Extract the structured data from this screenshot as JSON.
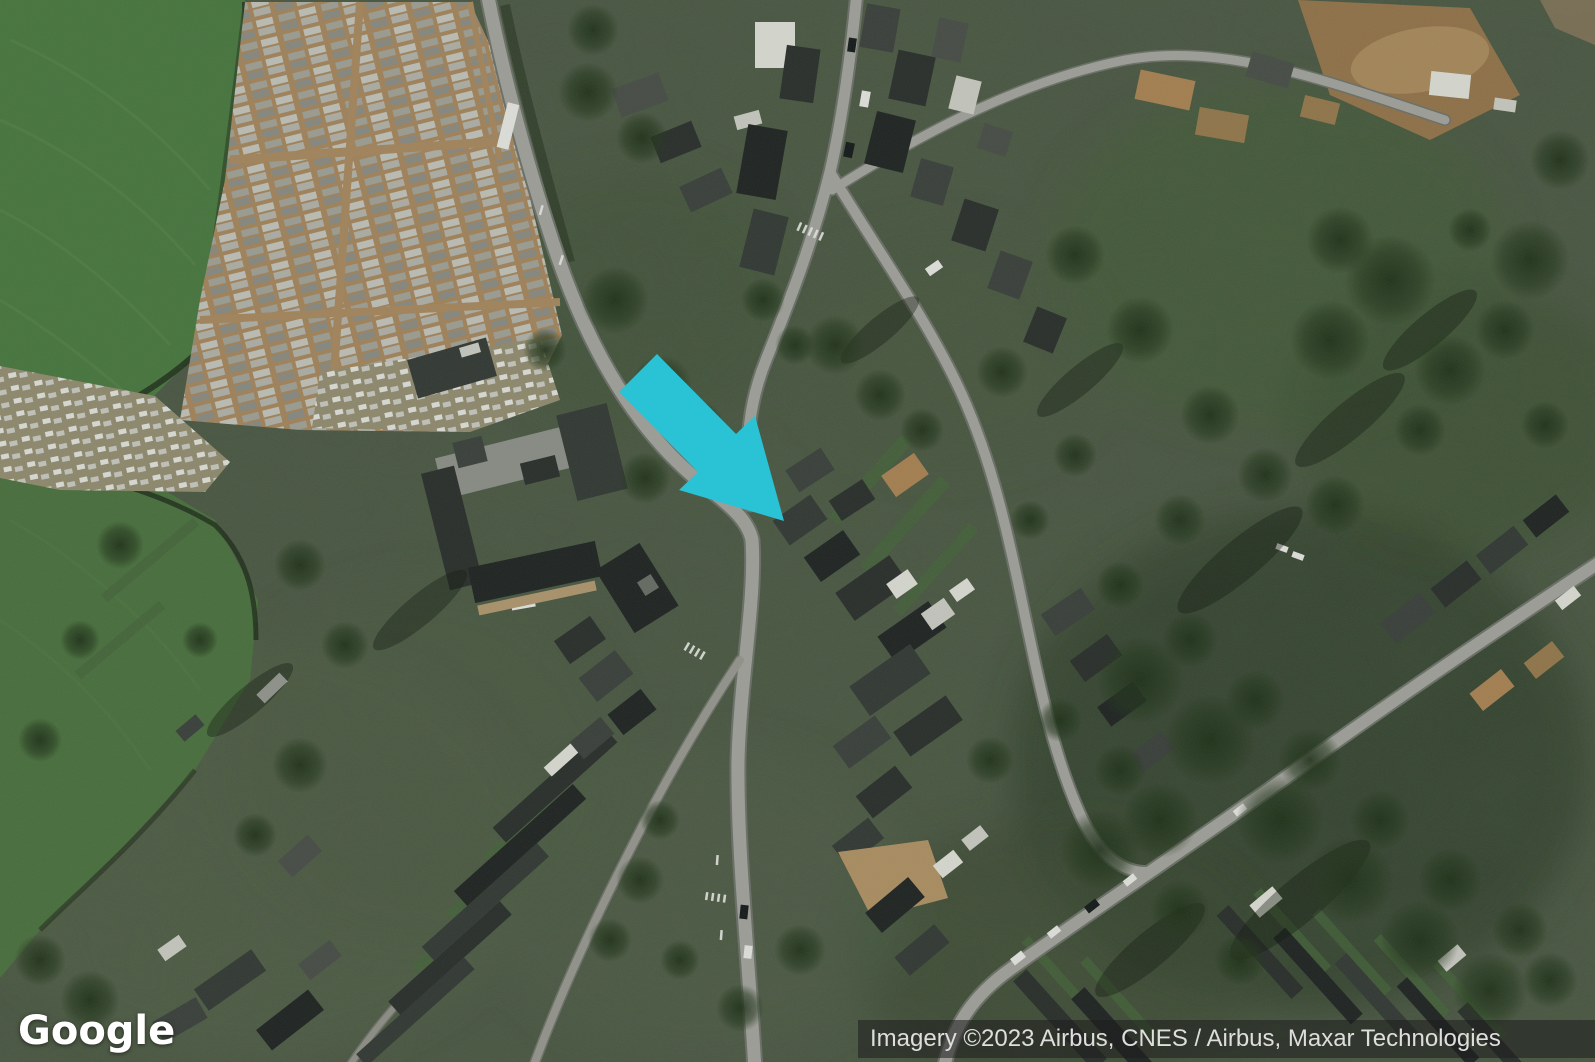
{
  "branding": {
    "logo_text": "Google"
  },
  "attribution": {
    "text": "Imagery ©2023 Airbus, CNES / Airbus, Maxar Technologies"
  },
  "marker": {
    "name": "location-arrow",
    "color": "#29c3d5",
    "direction": "southeast"
  },
  "palette": {
    "field_green": "#4a7a41",
    "woodland_dark": "#2f4029",
    "road_gray": "#a6a6a0",
    "cemetery_tan": "#a9885f",
    "attribution_text": "#dededc",
    "logo_text": "#ffffff"
  }
}
